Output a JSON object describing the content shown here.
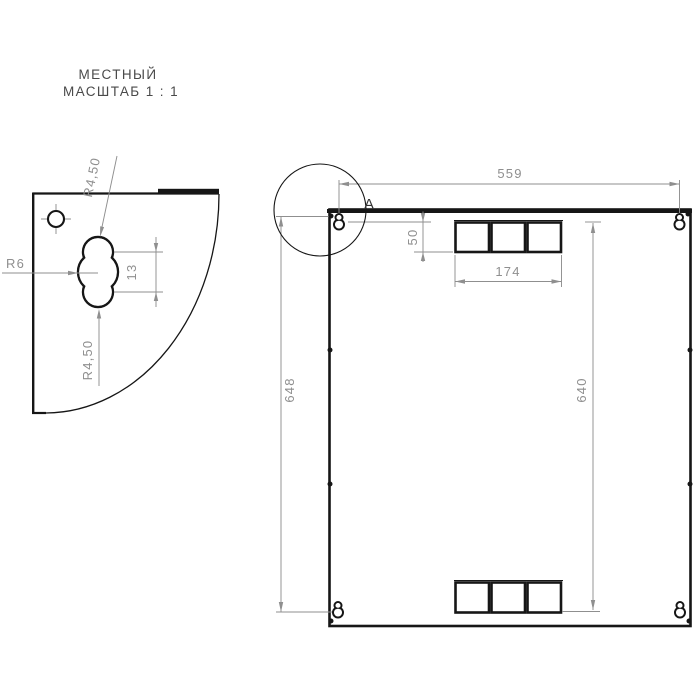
{
  "drawing_title": {
    "line1": "МЕСТНЫЙ",
    "line2": "МАСШТАБ 1 : 1"
  },
  "local_view": {
    "dimensions": {
      "slot_radius_top": "R4,50",
      "slot_radius_center": "R6",
      "slot_center_spacing": "13",
      "slot_radius_bottom": "R4,50"
    }
  },
  "main_view": {
    "detail_label": "A",
    "dimensions": {
      "top_width": "559",
      "vent_top_offset": "50",
      "vent_width": "174",
      "left_height": "648",
      "right_height": "640"
    }
  },
  "colors": {
    "line": "#161616",
    "dimension": "#8f8f8f",
    "title_text": "#4a4a4a",
    "background": "#ffffff"
  }
}
